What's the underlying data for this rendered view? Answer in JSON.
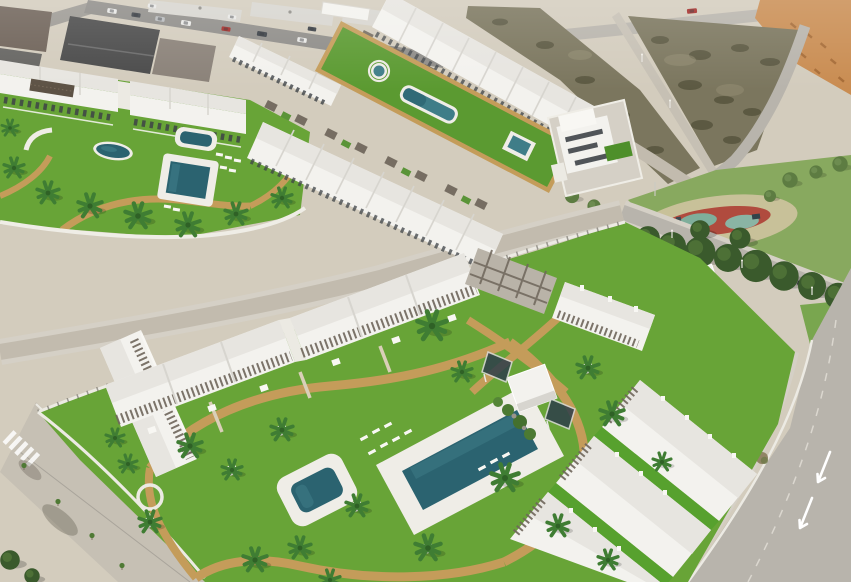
{
  "scene": {
    "kind": "aerial 3D architectural render photograph",
    "alt": "Aerial view of a new-build coastal residential development: white modern apartment blocks and terraced townhouses around landscaped lawns with swimming pools, palm trees and sand-coloured walking paths, next to existing town streets with parked cars, a vacant scrub plot, orange graded earth, a public park with a red playground court and pine trees, and perimeter roads with a zebra crossing, lane arrows and young street trees.",
    "visible_text": [],
    "features": [
      "existing town street with parked cars",
      "small white warehouse building",
      "vacant scrub lot bordered by roads with street lamps",
      "orange graded-earth corner plot",
      "terraced-house development with long communal garden strip containing round, freeform and square pools",
      "apartment row with lawn, eye-shaped pool, two rectangular pools, sun loungers and palm trees",
      "detached two-storey white villa with artificial turf garden",
      "public park with red playground court, teal play surfaces and dense pine trees",
      "white park kiosk",
      "large apartment complex with central courtyard, large rectangular pool, small square pool, white cube store, leaning glass panels, white-based palm trees and curving tan paths",
      "wide boulevard with zebra crossing, newly planted saplings and tree shadows",
      "road with white lane arrows"
    ],
    "counts": {
      "swimming_pools": 8,
      "development_phases": 3,
      "parked_cars_town_street": 12
    }
  },
  "palette": {
    "sand": "#d3ccbd",
    "townRoad": "#8e8c88",
    "roofDark": "#4a4a4a",
    "roofBrown": "#6e6258",
    "roofGray": "#8a8178",
    "building": "#f3f2ee",
    "roof": "#e7e5e0",
    "roofShade": "#d7d5cf",
    "pergola": "#6f665b",
    "frame": "#b9b3a8",
    "lawn": "#68a437",
    "stripLawn": "#5b9a31",
    "turf": "#4e8f2a",
    "turfBright": "#57a12e",
    "parkGrass": "#88a95f",
    "verge": "#79a64f",
    "treeDark": "#3a5a2c",
    "treeLight": "#5d7c42",
    "palm": "#3f7d33",
    "palmDark": "#2f6126",
    "pathTan": "#c49c5a",
    "pathLight": "#d9cfb8",
    "poolWater": "#2b6370",
    "poolLight": "#3f7d88",
    "poolDeck": "#efede7",
    "road": "#b8b4ac",
    "roadLight": "#c6c0b4",
    "roadC": "#c2bbae",
    "sidewalk": "#d5d0c6",
    "curb": "#eceae3",
    "wall": "#efede6",
    "dirtLot": "#7b765e",
    "scrub": "#55523c",
    "scrubLight": "#968f74",
    "dirtOrange": "#c98c51",
    "moundOrange": "#a66b36",
    "playRed": "#b04b3e",
    "playTeal": "#7fae9b",
    "playTeal2": "#8ab4a4",
    "sandPatch": "#cfc3a0",
    "carWhite": "#e8e8e6",
    "carDark": "#3a3f45",
    "carRed": "#a32a26",
    "carSilver": "#b9bcbe",
    "windows": "#3e4347",
    "glass": "#2e3e4a",
    "white": "#f8f7f3",
    "shadow": "#4a4438"
  }
}
